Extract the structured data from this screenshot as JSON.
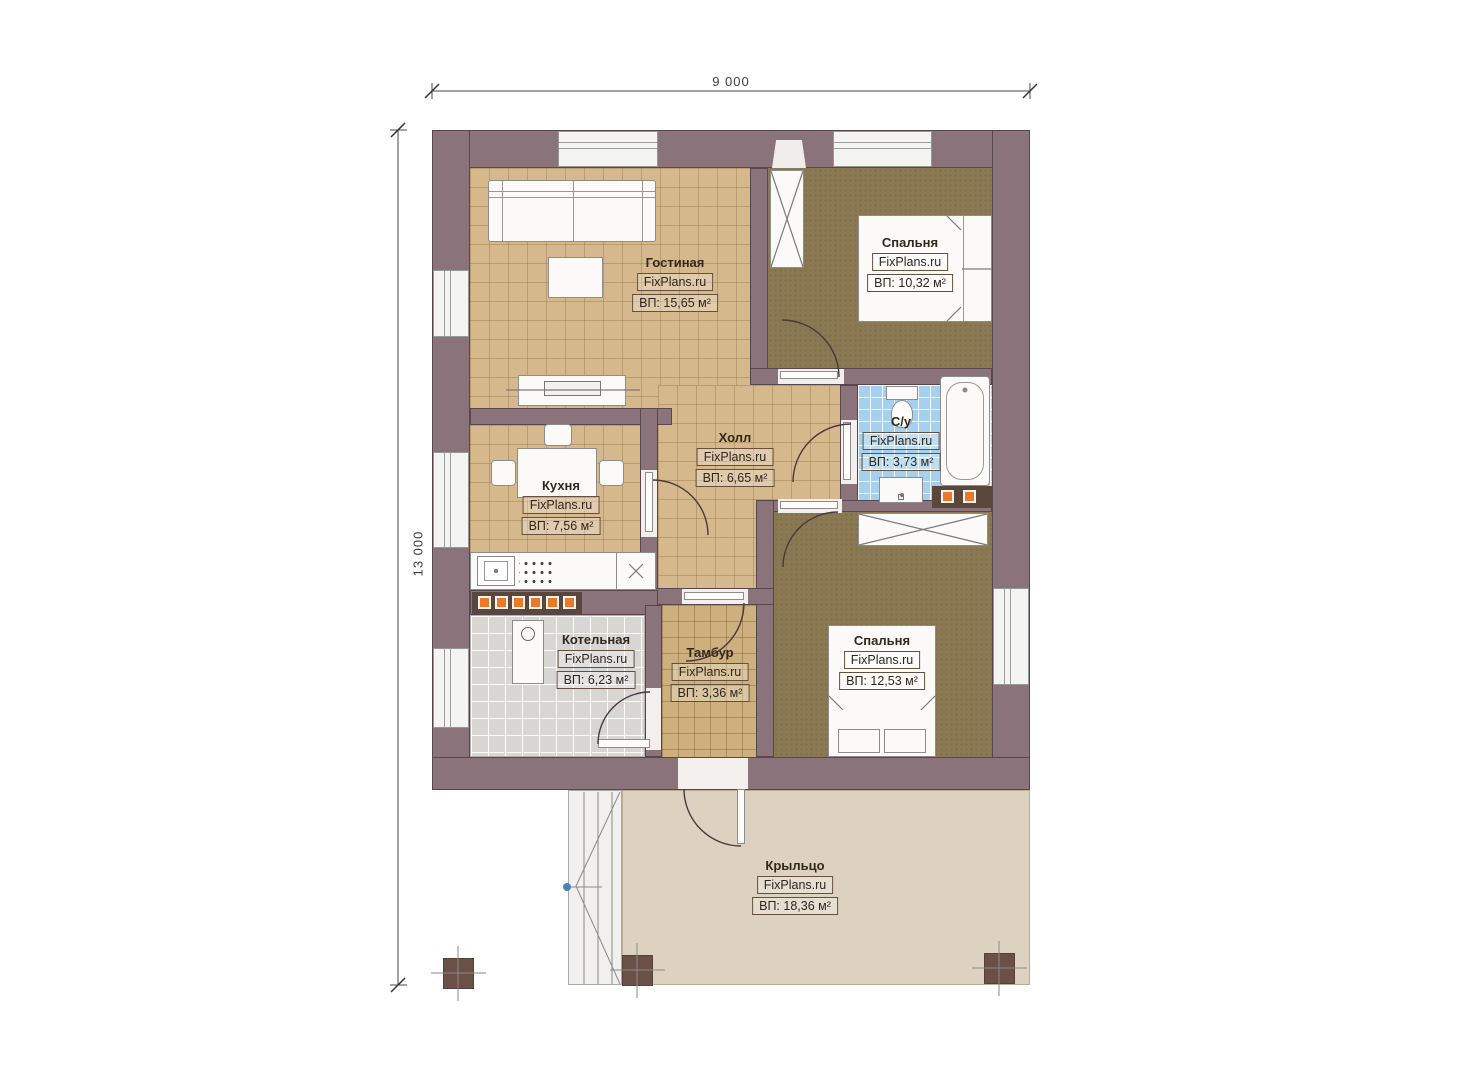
{
  "dimensions": {
    "width": "9 000",
    "height": "13 000"
  },
  "brand": "FixPlans.ru",
  "rooms": [
    {
      "id": "living",
      "name": "Гостиная",
      "brand": "FixPlans.ru",
      "area": "ВП: 15,65 м²"
    },
    {
      "id": "bedroom-1",
      "name": "Спальня",
      "brand": "FixPlans.ru",
      "area": "ВП: 10,32 м²"
    },
    {
      "id": "bathroom",
      "name": "С/у",
      "brand": "FixPlans.ru",
      "area": "ВП: 3,73 м²"
    },
    {
      "id": "hall",
      "name": "Холл",
      "brand": "FixPlans.ru",
      "area": "ВП: 6,65 м²"
    },
    {
      "id": "kitchen",
      "name": "Кухня",
      "brand": "FixPlans.ru",
      "area": "ВП: 7,56 м²"
    },
    {
      "id": "boiler",
      "name": "Котельная",
      "brand": "FixPlans.ru",
      "area": "ВП: 6,23 м²"
    },
    {
      "id": "vestibule",
      "name": "Тамбур",
      "brand": "FixPlans.ru",
      "area": "ВП: 3,36 м²"
    },
    {
      "id": "bedroom-2",
      "name": "Спальня",
      "brand": "FixPlans.ru",
      "area": "ВП: 12,53 м²"
    },
    {
      "id": "porch",
      "name": "Крыльцо",
      "brand": "FixPlans.ru",
      "area": "ВП: 18,36 м²"
    }
  ],
  "colors": {
    "wall": "#8a737a",
    "floor_tan": "#d5b98c",
    "floor_olive": "#8a7952",
    "floor_blue": "#a6d1ee",
    "floor_gray": "#d7d6d3",
    "porch": "#ddd1bf",
    "radiator_orange": "#ea7a2a",
    "column_brown": "#6b5048"
  }
}
